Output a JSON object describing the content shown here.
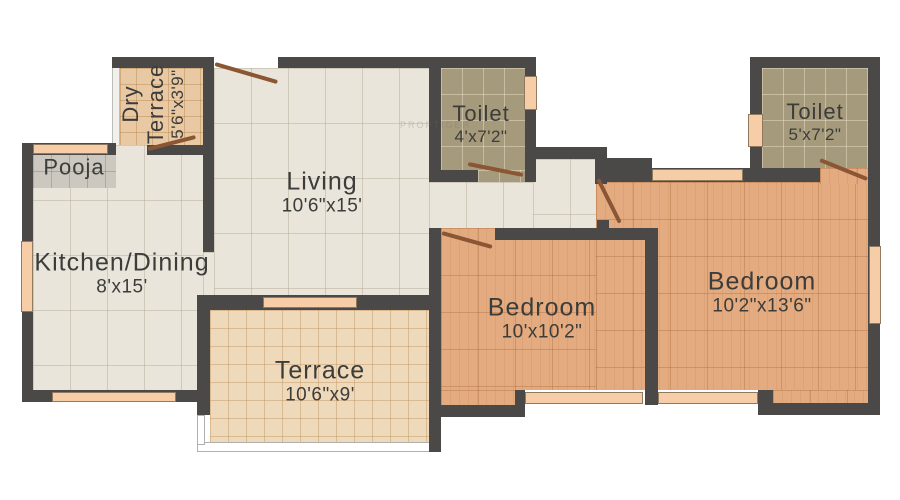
{
  "colors": {
    "wall": "#4a4947",
    "window": "#f6cda6",
    "door": "#8a5634",
    "floor_living": "#eae5da",
    "floor_bedroom": "#e3ab7f",
    "floor_toilet": "#a69a7c",
    "floor_terrace": "#eed9ba",
    "floor_dry_terrace": "#e8c9a3",
    "floor_pooja": "#ccc8bf"
  },
  "rooms": {
    "pooja": {
      "name": "Pooja"
    },
    "dry_terrace": {
      "name_line1": "Dry",
      "name_line2": "Terrace",
      "dims": "5'6\"x3'9\""
    },
    "living": {
      "name": "Living",
      "dims": "10'6\"x15'"
    },
    "kitchen": {
      "name": "Kitchen/Dining",
      "dims": "8'x15'"
    },
    "terrace": {
      "name": "Terrace",
      "dims": "10'6\"x9'"
    },
    "toilet_1": {
      "name": "Toilet",
      "dims": "4'x7'2\""
    },
    "toilet_2": {
      "name": "Toilet",
      "dims": "5'x7'2\""
    },
    "bedroom_1": {
      "name": "Bedroom",
      "dims": "10'x10'2\""
    },
    "bedroom_2": {
      "name": "Bedroom",
      "dims": "10'2\"x13'6\""
    }
  },
  "watermark": {
    "text": "PROPTIGER"
  }
}
